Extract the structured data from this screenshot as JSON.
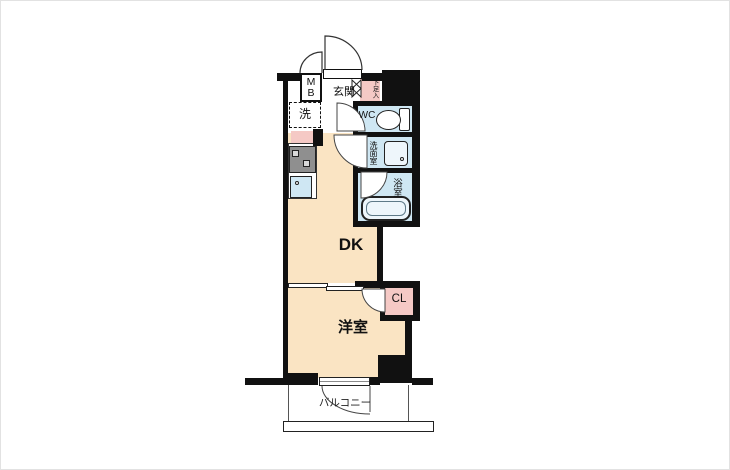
{
  "colors": {
    "floor": "#fae4c3",
    "wet_area": "#cfe7f3",
    "accent_pink": "#f5c9c5",
    "wall": "#111111"
  },
  "rooms": {
    "mb": "M\nB",
    "genkan": "玄関",
    "shoe_box": "下足入",
    "laundry": "洗",
    "wc": "WC",
    "washroom": "洗面室",
    "bathroom": "浴室",
    "dk": "DK",
    "closet": "CL",
    "bedroom": "洋室",
    "balcony": "バルコニー"
  }
}
